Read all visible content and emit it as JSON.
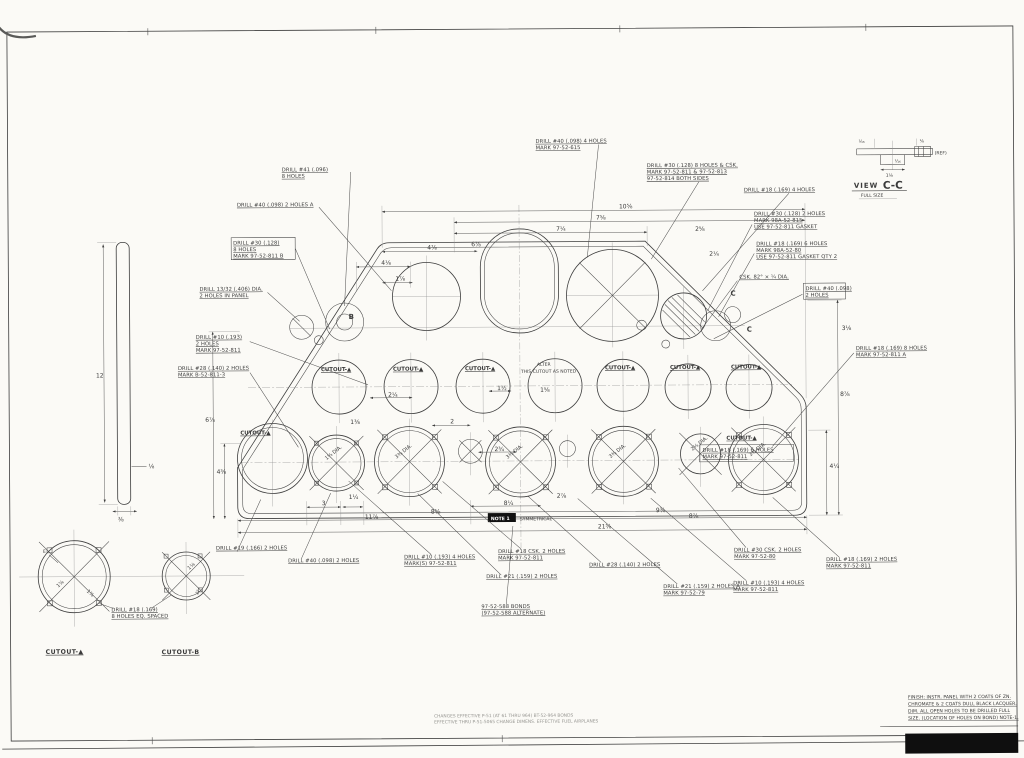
{
  "colors": {
    "paper": "#fbfaf6",
    "ink": "#3d3d3d",
    "faint": "#8f8f8f",
    "black": "#0f0f0f"
  },
  "view_cc": {
    "title": "VIEW",
    "section": "C-C",
    "scale": "FULL SIZE",
    "ref": "(REF)",
    "d1": "¹⁄₁₆",
    "d2": "⅛",
    "d3": "¹⁄₁₆",
    "d4": "1⅛"
  },
  "details": {
    "a_title": "CUTOUT-▲",
    "b_title": "CUTOUT-B",
    "e_label": "E"
  },
  "panel": {
    "cutout_label": "CUTOUT-▲",
    "alter": [
      "ALTER",
      "THIS CUTOUT AS NOTED"
    ]
  },
  "centerline_note": {
    "box": "NOTE 1",
    "text": "SYMMETRICAL"
  },
  "flags": {
    "b": "B",
    "c": "C"
  },
  "dims": [
    "10⅝",
    "7⅝",
    "7¼",
    "6⅞",
    "4⅞",
    "4⅛",
    "1⅞",
    "2⅝",
    "2¼",
    "3⅛",
    "8⅞",
    "4¼",
    "12",
    "⅜",
    "⅛",
    "6⅞",
    "4⅜",
    "3",
    "1¼",
    "11⅞",
    "8⅝",
    "8¼",
    "2⅞",
    "9⅜",
    "21⅝",
    "2¼",
    "1½",
    "1⅝",
    "1⅜",
    "2",
    "2¾",
    "8⅞"
  ],
  "dia": [
    "3⅜ DIA.",
    "3⅜ DIA.",
    "3⅜ DIA.",
    "3⅜ DIA.",
    "2⅛ DIA.",
    "1⅝ DIA.",
    "1⅝",
    "1⅞",
    "1⅛",
    "⅞"
  ],
  "callouts": [
    {
      "lines": [
        "DRILL #41 (.096)",
        "8 HOLES"
      ]
    },
    {
      "lines": [
        "DRILL #40 (.098) 2 HOLES A"
      ]
    },
    {
      "lines": [
        "DRILL #30 (.128)",
        "8 HOLES",
        "MARK 97-52-811 B"
      ]
    },
    {
      "lines": [
        "DRILL 13/32 (.406) DIA.",
        "2 HOLES IN PANEL"
      ]
    },
    {
      "lines": [
        "DRILL #10 (.193)",
        "2 HOLES",
        "MARK 97-52-811"
      ]
    },
    {
      "lines": [
        "DRILL #28 (.140) 2 HOLES",
        "MARK B-52-811-3"
      ]
    },
    {
      "lines": [
        "DRILL #40 (.098) 4 HOLES",
        "MARK 97-52-615"
      ]
    },
    {
      "lines": [
        "DRILL #30 (.128) 8 HOLES & CSK.",
        "MARK 97-52-811 & 97-52-813",
        "97-52-814 BOTH SIDES"
      ]
    },
    {
      "lines": [
        "DRILL #18 (.169) 4 HOLES"
      ]
    },
    {
      "lines": [
        "DRILL #30 (.128) 2 HOLES",
        "MARK 98A-52-815",
        "USE 97-52-811 GASKET"
      ]
    },
    {
      "lines": [
        "DRILL #18 (.169) 6 HOLES",
        "MARK 98A-52-80",
        "USE 97-52-811 GASKET QTY 2"
      ]
    },
    {
      "lines": [
        "CSK. 82° × ¼ DIA."
      ]
    },
    {
      "lines": [
        "DRILL #40 (.098)",
        "2 HOLES"
      ]
    },
    {
      "lines": [
        "DRILL #18 (.169) 8 HOLES",
        "MARK 97-52-811 A"
      ]
    },
    {
      "lines": [
        "DRILL #18 (.169) 6 HOLES",
        "MARK 97-52-811"
      ]
    },
    {
      "lines": [
        "DRILL #40 (.098) 2 HOLES"
      ]
    },
    {
      "lines": [
        "DRILL #10 (.193) 4 HOLES",
        "MARK(S) 97-52-811"
      ]
    },
    {
      "lines": [
        "DRILL #18 CSK. 2 HOLES",
        "MARK 97-52-811"
      ]
    },
    {
      "lines": [
        "DRILL #21 (.159) 2 HOLES"
      ]
    },
    {
      "lines": [
        "DRILL #28 (.140) 2 HOLES"
      ]
    },
    {
      "lines": [
        "DRILL #21 (.159) 2 HOLES A",
        "MARK 97-52-79"
      ]
    },
    {
      "lines": [
        "DRILL #30 CSK. 2 HOLES",
        "MARK 97-52-80"
      ]
    },
    {
      "lines": [
        "DRILL #10 (.193) 4 HOLES",
        "MARK 97-52-811"
      ]
    },
    {
      "lines": [
        "DRILL #18 (.169) 2 HOLES",
        "MARK 97-52-811"
      ]
    },
    {
      "lines": [
        "97-52-588 BONDS",
        "(97-52-588 ALTERNATE)"
      ]
    },
    {
      "lines": [
        "DRILL #18 (.169)",
        "8 HOLES EQ. SPACED"
      ]
    },
    {
      "lines": [
        "DRILL #19 (.166) 2 HOLES"
      ]
    }
  ],
  "notes": [
    "FINISH: INSTR. PANEL WITH 2 COATS OF ZN.",
    "CHROMATE & 2 COATS DULL BLACK LACQUER.",
    "DIM. ALL OPEN HOLES TO BE DRILLED FULL",
    "SIZE. (LOCATION OF HOLES ON BOND) NOTE-1."
  ],
  "effectivity": [
    "CHANGES EFFECTIVE P-51 (AT 61 THRU 964) BT-52-964 BONDS",
    "EFFECTIVE THRU P-51-5065 CHANGE DIMENS. EFFECTIVE FUEL AIRPLANES"
  ]
}
